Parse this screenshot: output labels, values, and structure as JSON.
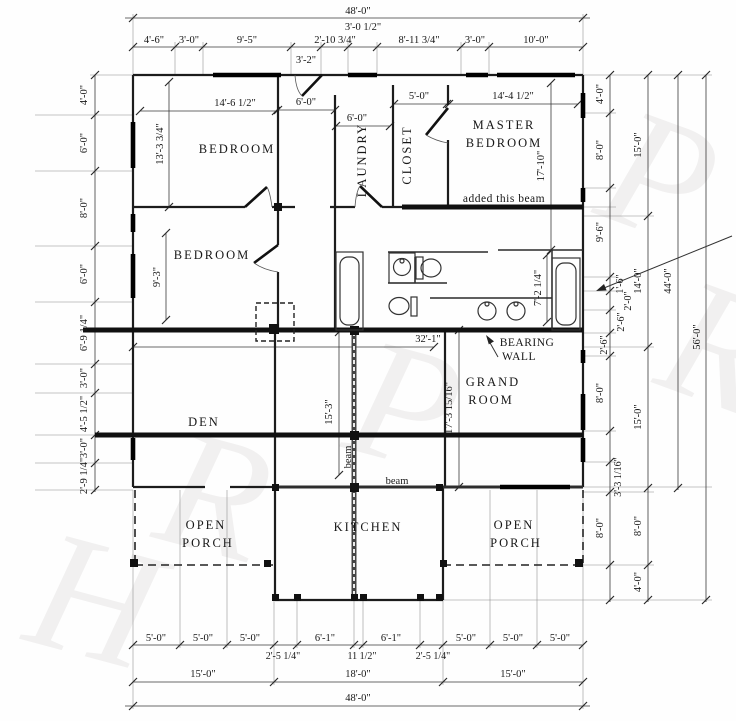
{
  "drawing": {
    "rooms": {
      "bedroom_top": "BEDROOM",
      "bedroom_mid": "BEDROOM",
      "laundry": "LAUNDRY",
      "closet": "CLOSET",
      "master_line1": "MASTER",
      "master_line2": "BEDROOM",
      "grand_line1": "GRAND",
      "grand_line2": "ROOM",
      "den": "DEN",
      "kitchen": "KITCHEN",
      "porch_left_line1": "OPEN",
      "porch_left_line2": "PORCH",
      "porch_right_line1": "OPEN",
      "porch_right_line2": "PORCH"
    },
    "notes": {
      "added_beam": "added this beam",
      "bearing_line1": "BEARING",
      "bearing_line2": "WALL",
      "beam_vertical": "beam",
      "beam_horizontal": "beam"
    },
    "dims": {
      "top": {
        "overall": "48'-0\"",
        "raised": "3'-0 1/2\"",
        "below": "3'-2\"",
        "row": [
          "4'-6\"",
          "3'-0\"",
          "9'-5\"",
          "2'-10 3/4\"",
          "8'-11 3/4\"",
          "3'-0\"",
          "10'-0\""
        ]
      },
      "left": [
        "4'-0\"",
        "6'-0\"",
        "8'-0\"",
        "6'-0\"",
        "6'-9 1/4\"",
        "3'-0\"",
        "4'-5 1/2\"",
        "3'-0\"",
        "2'-9 1/4\""
      ],
      "right_inner": [
        "4'-0\"",
        "8'-0\"",
        "9'-6\"",
        "1'-6\"",
        "2'-0\"",
        "2'-6\"",
        "2'-6\"",
        "8'-0\"",
        "3'-3 1/16\"",
        "8'-0\""
      ],
      "right_mid": [
        "15'-0\"",
        "14'-0\"",
        "15'-0\"",
        "8'-0\"",
        "4'-0\""
      ],
      "right_house_total": "44'-0\"",
      "right_overall": "56'-0\"",
      "bottom_row": [
        "5'-0\"",
        "5'-0\"",
        "5'-0\"",
        "2'-5 1/4\"",
        "6'-1\"",
        "11 1/2\"",
        "6'-1\"",
        "2'-5 1/4\"",
        "5'-0\"",
        "5'-0\"",
        "5'-0\""
      ],
      "bottom_mid": [
        "15'-0\"",
        "18'-0\"",
        "15'-0\""
      ],
      "bottom_overall": "48'-0\"",
      "interior": {
        "bedroom_top_w": "14'-6 1/2\"",
        "bedroom_top_h": "13'-3 3/4\"",
        "hall_w": "6'-0\"",
        "laundry_w": "6'-0\"",
        "closet_w": "5'-0\"",
        "master_w": "14'-4 1/2\"",
        "master_h": "17'-10\"",
        "bedroom_mid_h": "9'-3\"",
        "master_bath_h": "7'-2 1/4\"",
        "bearing_span": "32'-1\"",
        "grand_h": "17'-3 15/16\"",
        "den_h": "15'-3\""
      }
    },
    "watermark": [
      "P",
      "R",
      "P",
      "R",
      "H"
    ]
  }
}
